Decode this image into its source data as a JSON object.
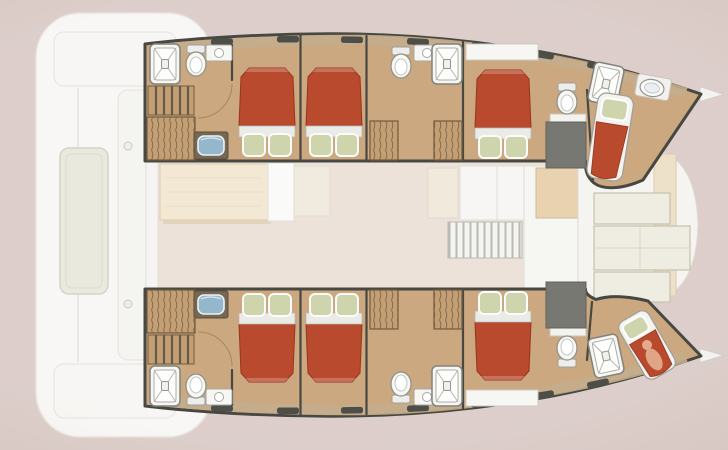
{
  "title": "Catamaran yacht interior layout floor plan",
  "vessel": {
    "type": "sailing catamaran deck plan (top view)",
    "orientation": "bows pointing right, aft deck at left",
    "hulls": [
      "port hull (top)",
      "starboard hull (bottom)"
    ]
  },
  "counts": {
    "double_cabins": 6,
    "forepeak_berths": 2,
    "heads_bathrooms": 6,
    "showers": 6,
    "toilets": 6,
    "staircases": 2
  },
  "regions": {
    "aft_deck": {
      "label": "Aft deck",
      "features": [
        "sun pad lounger",
        "aft bench seating",
        "forward bench seating",
        "deck cleats"
      ]
    },
    "saloon": {
      "label": "Saloon and galley",
      "features": [
        "dining table",
        "sofa bench",
        "seat cushion",
        "galley counter",
        "galley cabinet",
        "companionway grate steps",
        "tall galley unit",
        "entry step"
      ]
    },
    "forward_cockpit": {
      "label": "Forward cockpit",
      "features": [
        "cream lockers",
        "seat panels",
        "wood trim strip"
      ]
    },
    "port_hull": {
      "label": "Port hull (top)",
      "compartments": [
        {
          "label": "Aft head",
          "features": [
            "shower cubicle",
            "toilet",
            "washbasin vanity",
            "staircase",
            "louvered wardrobe",
            "blue sink vanity"
          ]
        },
        {
          "label": "Aft double cabin",
          "features": [
            "double bed, red duvet, two green pillows"
          ]
        },
        {
          "label": "Midship double cabin",
          "features": [
            "double bed, red duvet, two green pillows"
          ]
        },
        {
          "label": "Midship head",
          "features": [
            "toilet",
            "washbasin vanity",
            "shower cubicle",
            "two louvered wardrobes"
          ]
        },
        {
          "label": "Forward double cabin",
          "features": [
            "desk shelf",
            "double bed, red duvet, two green pillows",
            "toilet",
            "counter",
            "dark utility unit"
          ]
        },
        {
          "label": "Forepeak crew berth",
          "features": [
            "shower cubicle",
            "washbasin",
            "single berth with green pillow and red blanket"
          ]
        }
      ]
    },
    "starboard_hull": {
      "label": "Starboard hull (bottom)",
      "compartments": [
        {
          "label": "Aft head",
          "features": [
            "shower cubicle",
            "toilet",
            "washbasin vanity",
            "staircase",
            "louvered wardrobe",
            "blue sink vanity"
          ]
        },
        {
          "label": "Aft double cabin",
          "features": [
            "double bed, red duvet, two green pillows"
          ]
        },
        {
          "label": "Midship double cabin",
          "features": [
            "double bed, red duvet, two green pillows"
          ]
        },
        {
          "label": "Midship head",
          "features": [
            "toilet",
            "washbasin vanity",
            "shower cubicle",
            "two louvered wardrobes"
          ]
        },
        {
          "label": "Forward double cabin",
          "features": [
            "desk shelf",
            "double bed, red duvet, two green pillows",
            "toilet",
            "counter",
            "dark utility unit"
          ]
        },
        {
          "label": "Forepeak crew berth",
          "features": [
            "shower cubicle",
            "single berth with figure resting on red blanket"
          ]
        }
      ]
    },
    "bow_tips": {
      "label": "Bow points"
    }
  },
  "colors": {
    "background": "#dbccc8",
    "deck_white": "#f8f7f5",
    "deck_line": "#e4e1dd",
    "sun_pad": "#e9e8db",
    "hull_floor": "#c8a378",
    "hull_wall": "#3e3e38",
    "side_deck": "#c1a985",
    "window_slot": "#45453f",
    "bed_red": "#b54023",
    "bed_red_dark": "#932a10",
    "bed_sheet": "#e9e9e6",
    "pillow_green": "#ccd2a8",
    "fixture_white": "#f5f5f2",
    "fixture_line": "#8b8b85",
    "sink_blue": "#8fb3cb",
    "wood_step": "#c09a6c",
    "stair_line": "#5d5243",
    "wardrobe_line": "#7e6547",
    "saloon_floor": "#ebe0d7",
    "table_wood": "#f2e7d1",
    "table_edge": "#dbc9a8",
    "galley_white": "#f7f6f3",
    "panel_beige": "#f0e9dc",
    "locker_cream": "#eeece0",
    "locker_line": "#c2bfa8",
    "dark_unit": "#71716a",
    "bow_tip": "#f3f2ef",
    "skin": "#e2a585",
    "door_arc": "#a8824f"
  }
}
